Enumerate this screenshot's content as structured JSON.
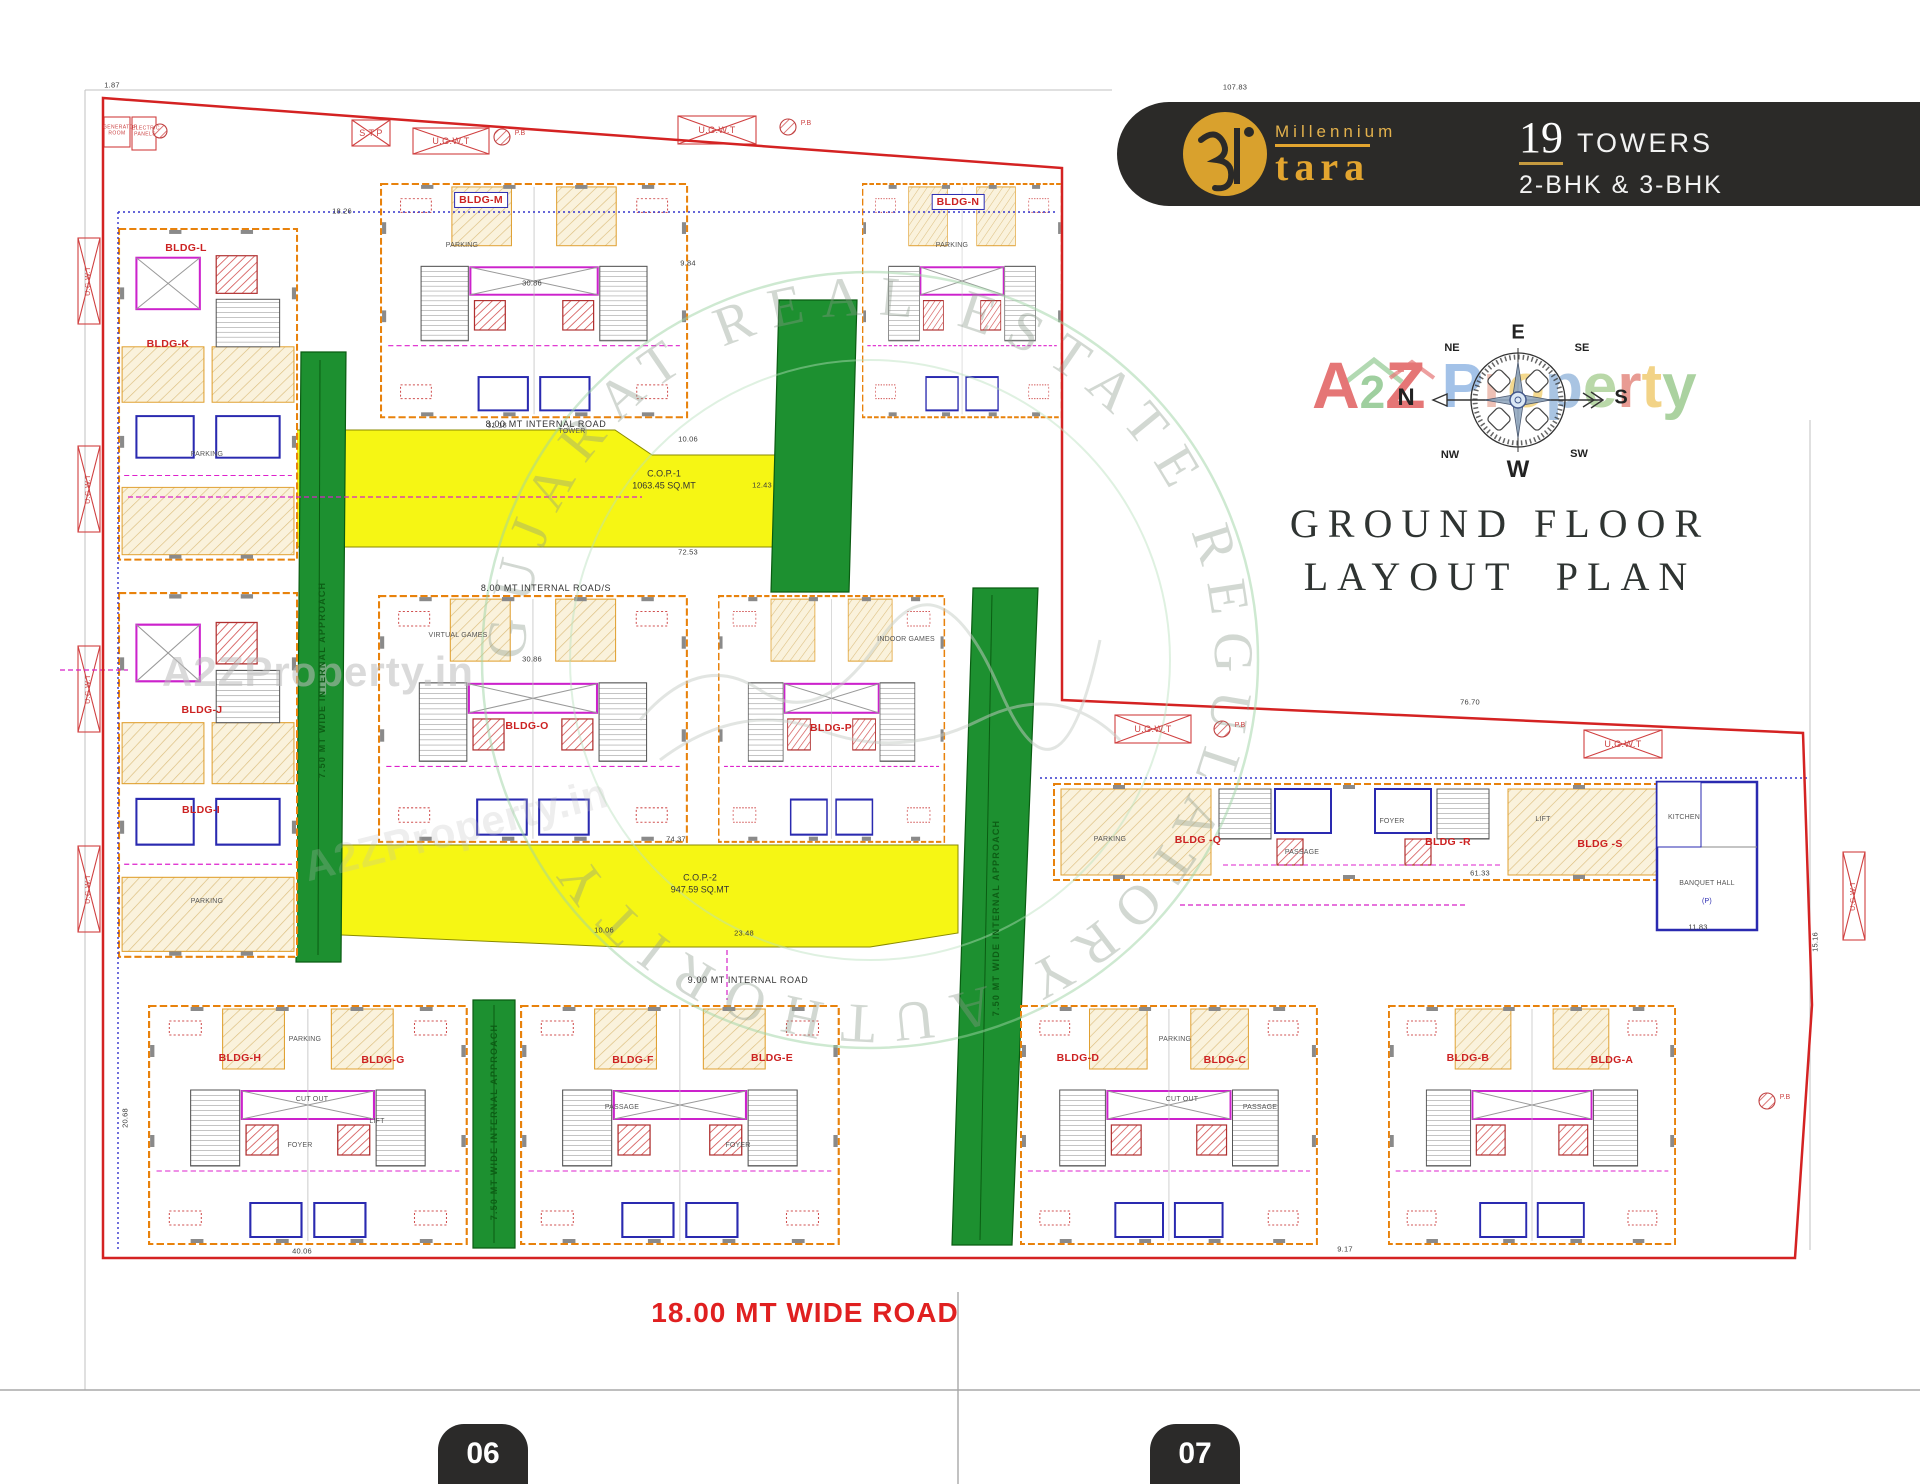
{
  "colors": {
    "badge_bg": "#2b2a28",
    "gold": "#d9a12d",
    "boundary_red": "#d42222",
    "road_green": "#1d9030",
    "cop_yellow": "#f6f614",
    "bldg_orange": "#e8820c",
    "wall_blue": "#2a2ab0",
    "note_magenta": "#d622c8",
    "label_red": "#cc2222"
  },
  "header": {
    "brand_top": "Millennium",
    "brand_name": "tara",
    "count": "19",
    "count_label": "TOWERS",
    "bhk": "2-BHK & 3-BHK"
  },
  "title": {
    "line1": "GROUND FLOOR",
    "line2": "LAYOUT  PLAN"
  },
  "compass": {
    "n": "N",
    "e": "E",
    "s": "S",
    "w": "W",
    "ne": "NE",
    "se": "SE",
    "sw": "SW",
    "nw": "NW"
  },
  "watermark": {
    "a2z": [
      {
        "ch": "A",
        "color": "#e57676"
      },
      {
        "ch": "2",
        "color": "#9fcf9f"
      },
      {
        "ch": "Z",
        "color": "#e57676"
      }
    ],
    "property": [
      {
        "ch": "P",
        "color": "#a3c2e8"
      },
      {
        "ch": "r",
        "color": "#eec1b6"
      },
      {
        "ch": "o",
        "color": "#f4d98e"
      },
      {
        "ch": "p",
        "color": "#a9c4e2"
      },
      {
        "ch": "e",
        "color": "#b9d8a8"
      },
      {
        "ch": "r",
        "color": "#e89b93"
      },
      {
        "ch": "t",
        "color": "#f2d387"
      },
      {
        "ch": "y",
        "color": "#abd2a0"
      }
    ],
    "site_text": "A2ZProperty.in",
    "ring_text": "GUJARAT REAL ESTATE REGULATORY AUTHORITY"
  },
  "plan": {
    "cop1_name": "C.O.P.-1",
    "cop1_area": "1063.45 SQ.MT",
    "cop2_name": "C.O.P.-2",
    "cop2_area": "947.59 SQ.MT",
    "roads": {
      "internal_8": "8.00 MT INTERNAL ROAD",
      "internal_8s": "8.00 MT INTERNAL ROAD/S",
      "internal_9": "9.00 MT INTERNAL ROAD",
      "approach": "7.50 MT WIDE INTERNAL APPROACH"
    },
    "utilities": {
      "stp": "S.T.P",
      "ugwt": "U.G.W.T",
      "pb": "P.B",
      "generator": "GENERATOR ROOM",
      "electric": "ELECTRIC PANELS"
    },
    "buildings": {
      "a": "BLDG-A",
      "b": "BLDG-B",
      "c": "BLDG-C",
      "d": "BLDG-D",
      "e": "BLDG-E",
      "f": "BLDG-F",
      "g": "BLDG-G",
      "h": "BLDG-H",
      "i": "BLDG-I",
      "j": "BLDG-J",
      "k": "BLDG-K",
      "l": "BLDG-L",
      "m": "BLDG-M",
      "n": "BLDG-N",
      "o": "BLDG-O",
      "p": "BLDG-P",
      "q": "BLDG -Q",
      "r": "BLDG -R",
      "s": "BLDG -S"
    },
    "rooms": {
      "parking": "PARKING",
      "passage": "PASSAGE",
      "foyer": "FOYER",
      "cutout": "CUT OUT",
      "lift": "LIFT",
      "tower": "TOWER",
      "virtual": "VIRTUAL GAMES",
      "indoor": "INDOOR GAMES",
      "kitchen": "KITCHEN",
      "banquet": "BANQUET HALL",
      "banquet_unit": "(P)"
    },
    "dims": {
      "d1": "107.83",
      "d2": "1.87",
      "d3": "76.70",
      "d4": "30.86",
      "d5": "31.18",
      "d6": "10.06",
      "d7": "72.53",
      "d8": "74.37",
      "d9": "23.48",
      "d11": "40.06",
      "d12": "9.17",
      "d13": "61.33",
      "d14": "20.68",
      "d15": "9.84",
      "d16": "18.26",
      "d17": "12.43",
      "d18": "15.16",
      "d19": "11.83"
    }
  },
  "footer": {
    "road": "18.00 MT WIDE ROAD",
    "page_left": "06",
    "page_right": "07"
  }
}
